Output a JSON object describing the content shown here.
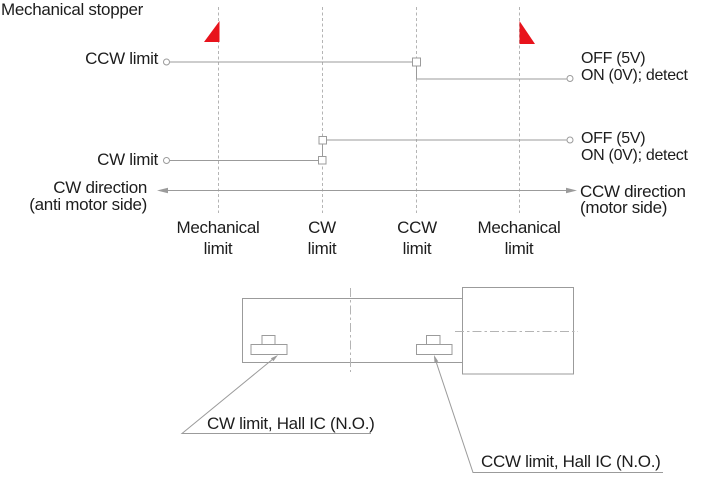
{
  "title": "Mechanical stopper",
  "timing": {
    "ccw_signal": {
      "label": "CCW limit",
      "state_high": "OFF (5V)",
      "state_low": "ON (0V); detect"
    },
    "cw_signal": {
      "label": "CW limit",
      "state_high": "OFF (5V)",
      "state_low": "ON (0V); detect"
    },
    "direction_left": {
      "line1": "CW direction",
      "line2": "(anti motor side)"
    },
    "direction_right": {
      "line1": "CCW direction",
      "line2": "(motor side)"
    },
    "positions": [
      {
        "line1": "Mechanical",
        "line2": "limit"
      },
      {
        "line1": "CW",
        "line2": "limit"
      },
      {
        "line1": "CCW",
        "line2": "limit"
      },
      {
        "line1": "Mechanical",
        "line2": "limit"
      }
    ]
  },
  "mechanism": {
    "callout_cw": "CW limit, Hall IC (N.O.)",
    "callout_ccw": "CCW limit, Hall IC (N.O.)"
  },
  "colors": {
    "line": "#9b9b9b",
    "dashline": "#b4b4b4",
    "red": "#e8131c",
    "text": "#1d1d1d"
  }
}
